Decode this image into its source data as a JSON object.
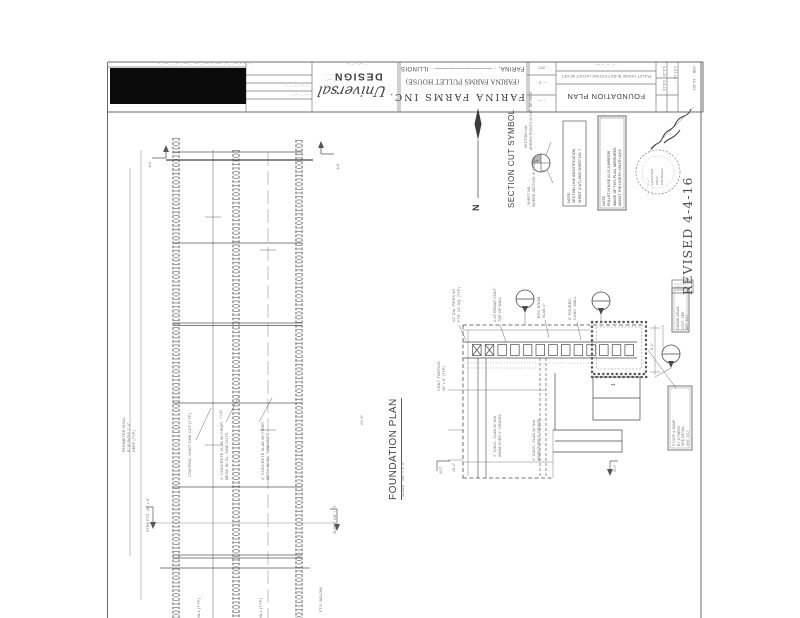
{
  "sheet": {
    "paper_color": "#ffffff",
    "ink_color": "#454545"
  },
  "title_block": {
    "rev_strip_note": "·– ··– –· ––· ·· –·· ––– ·–· –– ··· –– ··· ·–– ·· –·· ··· ––· ·–",
    "rev_row_1": "··– ––· ·–· ··· –",
    "rev_row_2": "–·– ··· –– ··",
    "logo": {
      "phone": "··· –··– ····–",
      "address_line_1": "––· ···· ··",
      "address_line_2": "····· ––· ·",
      "address_line_3": "··– ···· ––",
      "script_name": "Universal",
      "bold_name": "DESIGN"
    },
    "project": {
      "company": "FARINA FARMS INC.",
      "subtitle": "(FARINA FARMS PULLET HOUSE)",
      "city_state": "FARINA, ··–––––––––––––––··  ILLINOIS"
    },
    "seal_cell_row_1": "· 257 ·",
    "seal_cell_row_2": "–· 3 ·",
    "seal_cell_row_3": "– ––",
    "sheet_title_row_1": "· –· ·– ··– ––·",
    "sheet_title_row_2": "PULLET HOUSE BLDG FOOTING LAYOUT W/ DET.",
    "sheet_title_main": "FOUNDATION PLAN",
    "date_col_1": "4-4-16 · 3-8-16",
    "date_col_2": "1-27-16 · ··",
    "job_cell": "JOB ·· 16-103"
  },
  "drawing": {
    "plan_label": "FOUNDATION PLAN",
    "plan_scale": "SCALE : 1/8\" = 1'-0\"",
    "north_letter": "N",
    "legend_title": "SECTION CUT SYMBOL",
    "legend_top_note_1": "SECTION NO.",
    "legend_top_note_2": "ARROW POINTS IN DIR. OF VIEW",
    "legend_bottom_note_1": "SHEET NO.",
    "legend_bottom_note_2": "WHERE SECTION IS DRAWN",
    "legend_circle_top": "1",
    "legend_circle_bottom": "7",
    "note_a_line_1": "NOTE:",
    "note_a_line_2": "SECTION LINE IDENTIFICATION",
    "note_a_line_3": "SHEET (CUT) AND SHEET NO. 7",
    "note_b_line_1": "NOTE:",
    "note_b_line_2": "PULLET HOUSE #2 IS A MIRROR",
    "note_b_line_3": "IMAGE OF THIS PLAN, MIRRORED",
    "note_b_line_4": "ABOUT THE NORTH-SOUTH AXIS",
    "revised": "REVISED 4-4-16",
    "revised_box_note": "·· ––",
    "seal_row_1": "LICENSED",
    "seal_row_2": "PROF.",
    "seal_row_3": "ENGINEER",
    "sig_row_1": "··–· ···– –··",
    "sig_row_2": "–·· ··· ·–",
    "long_plan": {
      "marker_left": "1/4",
      "marker_right": "1/4",
      "left_note_1": "PERIMETER INSUL.",
      "left_note_2": "R-10 RIGID 2'-0\"",
      "left_note_3": "DEEP (TYP.)",
      "callout_1": "CONTROL JOINT SAW CUT (TYP.)",
      "callout_2a": "4\" CONCRETE SLAB W/ FIBER",
      "callout_2b": "MESH W/ SL. SAW CUTS",
      "callout_3a": "4\" CONCRETE SLAB W/ FIBER",
      "callout_3b": "MESH W/ SL. SAW CUTS",
      "dim_left": "STEP FTG. 16\" x 8\"",
      "dim_right": "SLOPE 1/8\" / FT.",
      "dim_mid": "+1.50",
      "dim_right_edge": "24'-0\"",
      "bottom_label_1": "8\" CONC. WALL (TYP.)",
      "bottom_label_2": "8\" CONC. WALL (TYP.)",
      "bottom_label_3": "FTG. BELOW"
    },
    "detail_plan": {
      "callout_1a": "12\" DIA. PIERS W/",
      "callout_1b": "FTG. 24\" SQ. (TYP.)",
      "callout_2a": "2-#5 REBAR CONT.",
      "callout_2b": "TOP OF WALL",
      "callout_3a": "EGG ROOM",
      "callout_3b": "SLAB 4\"",
      "callout_4a": "8\" POURED",
      "callout_4b": "CONC. WALL",
      "left_note_1": "CONT. FOOTING",
      "left_note_2": "16\" x 8\" (TYP.)",
      "left_dim": "18'-0\"",
      "interior_1a": "4\" CONC. SLAB W/ 6x6",
      "interior_1b": "WWM OVER 4\" GRAVEL",
      "interior_2a": "4\" CONC. SLAB W/ 6x6",
      "interior_2b": "WWM OVER 4\" GRAVEL",
      "room_number": "1",
      "marker_bottom": "5/17",
      "corner_marker": "3/17",
      "right_dim": "8'-0\"",
      "note_c_line_1": "GRADE BEAM",
      "note_c_line_2": "CONT. SEE",
      "note_c_line_3": "DET. 5/17",
      "note_d_line_1": "STOOP & RAMP",
      "note_d_line_2": "BY OTHERS",
      "note_d_line_3": "SEE DETAIL",
      "note_d_line_4": "SHT. 5/17"
    }
  }
}
